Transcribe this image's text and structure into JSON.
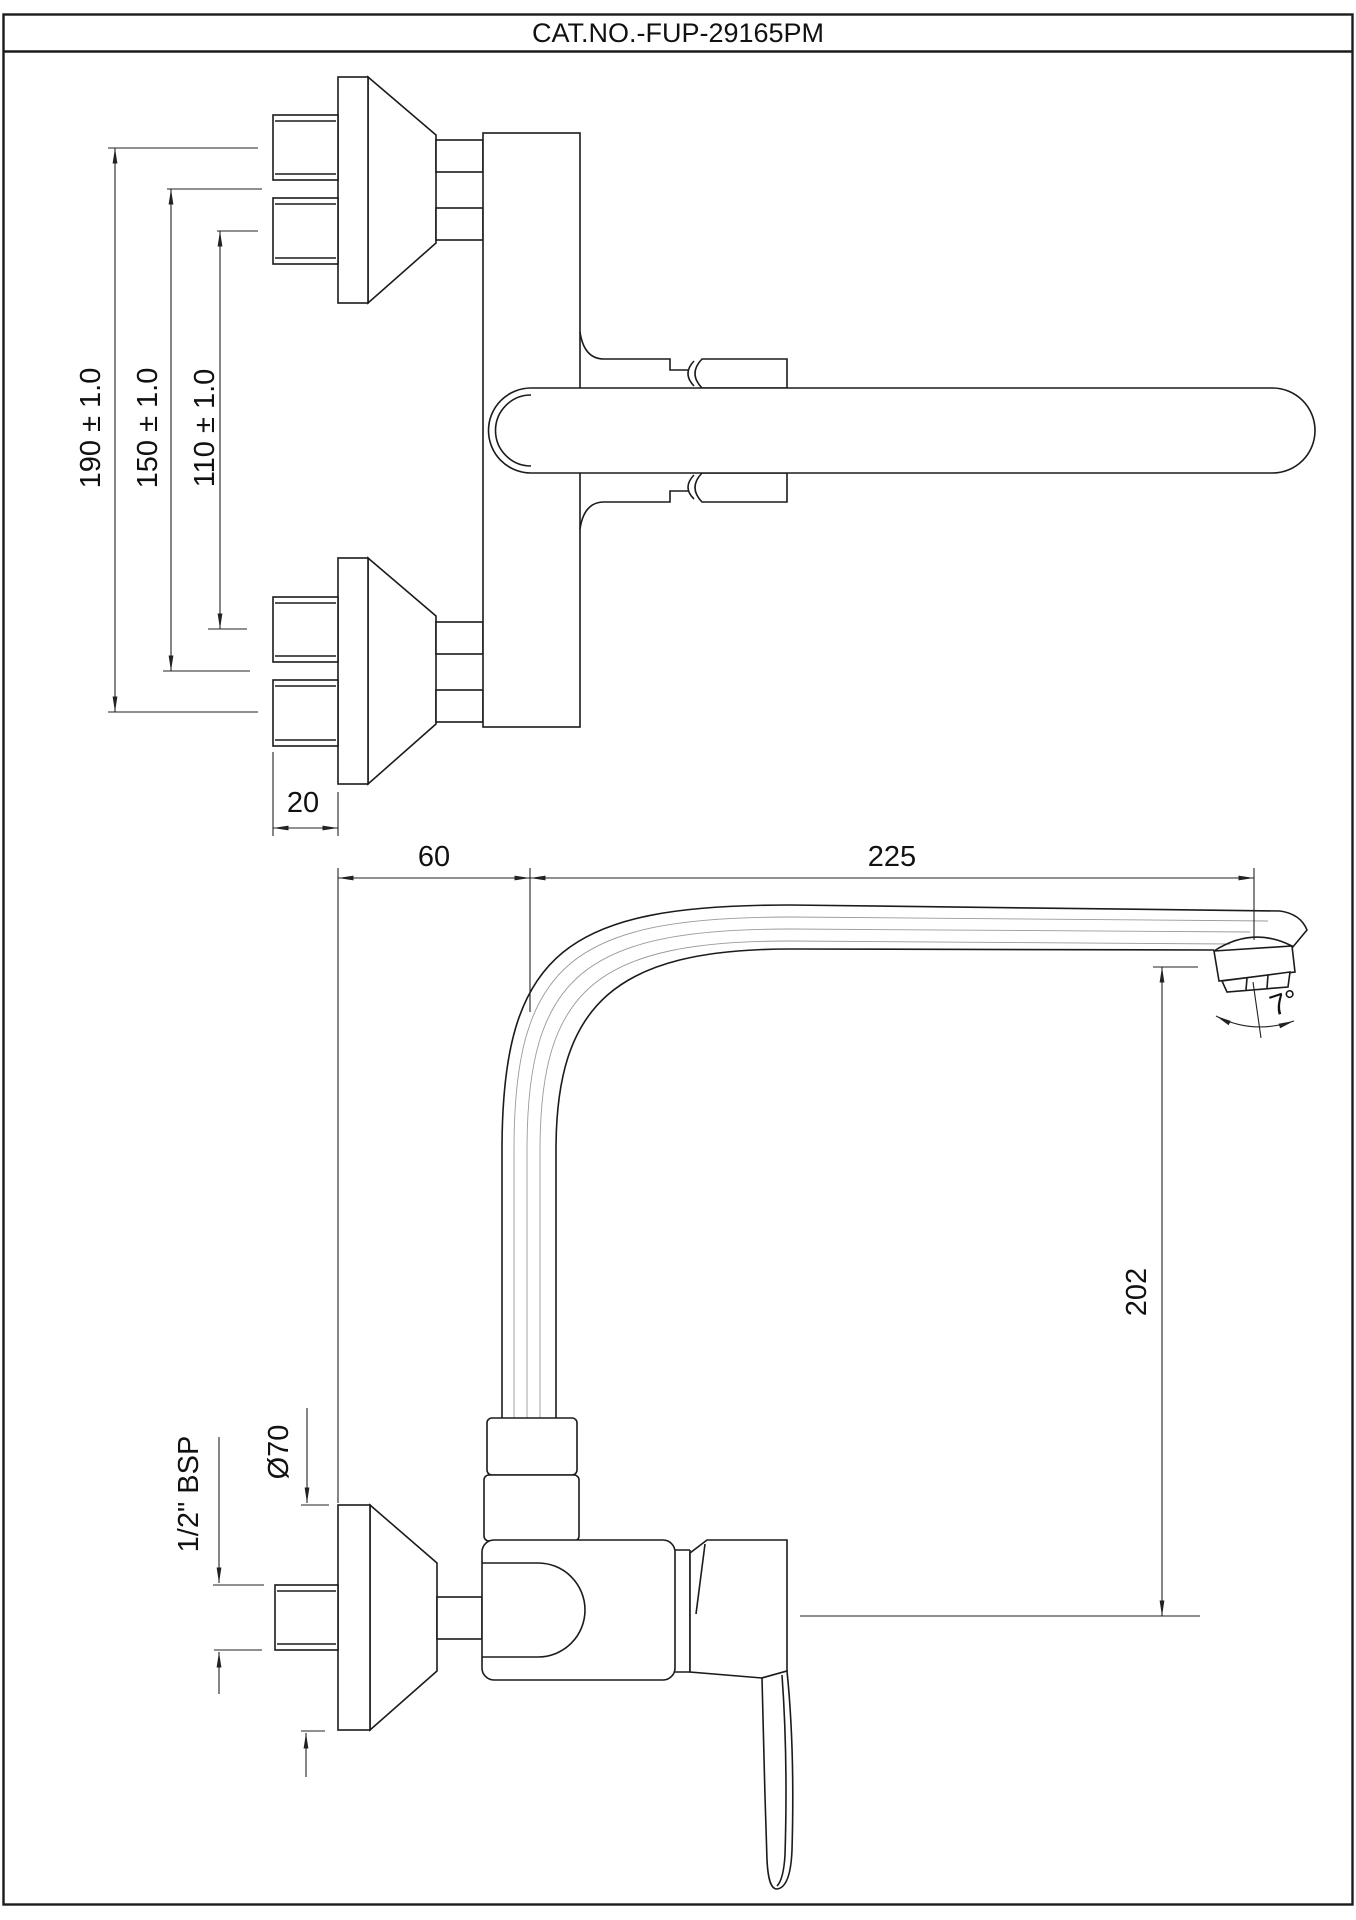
{
  "title": "CAT.NO.-FUP-29165PM",
  "colors": {
    "ink": "#1b1b1b",
    "background": "#ffffff"
  },
  "dims": {
    "d190": "190 ± 1.0",
    "d150": "150 ± 1.0",
    "d110": "110 ± 1.0",
    "d20": "20",
    "d60": "60",
    "d225": "225",
    "d202": "202",
    "d70": "Ø70",
    "dbsp": "1/2\" BSP",
    "d7": "7°"
  }
}
